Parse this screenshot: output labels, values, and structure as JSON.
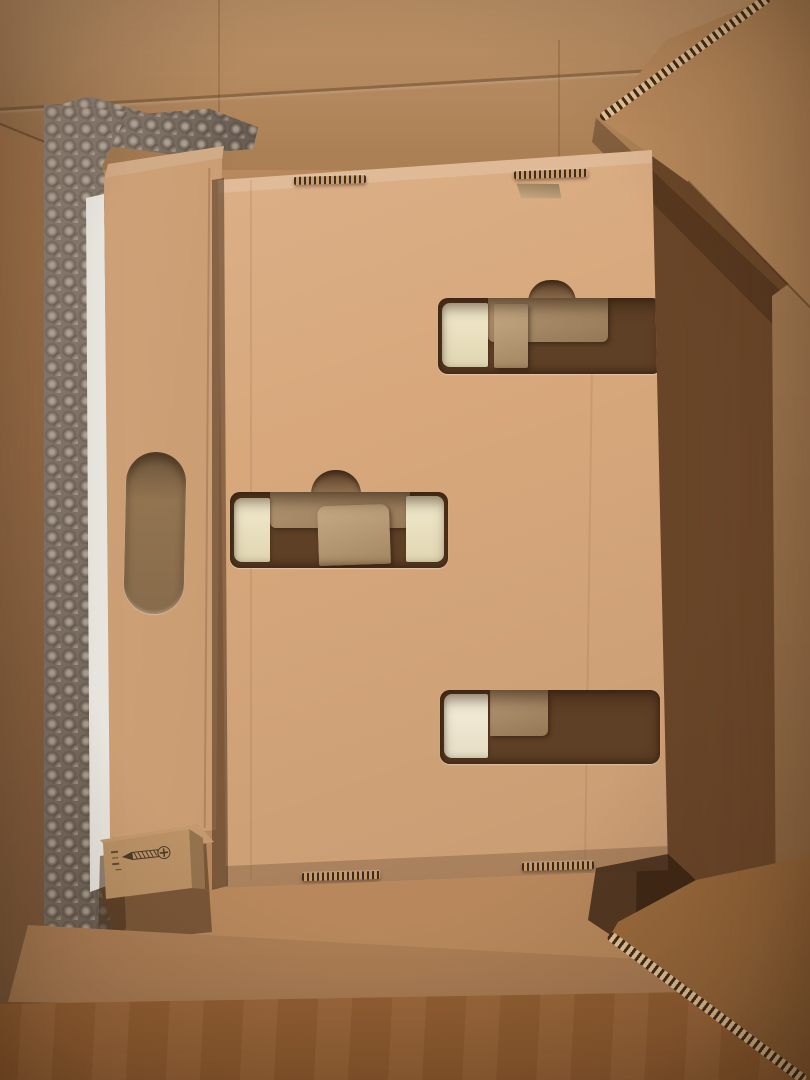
{
  "meta": {
    "type": "photograph",
    "description": "Top-down photo of an opened cardboard shipping box. Inside: a large flat cardboard insert box with three die-cut openings revealing pale wood blocks, a vertical cardboard panel with an oval hand-hole, bubble wrap and a white sheet along the left side, and a small kraft box printed with a screw pictogram. Box flaps are open at the top-right, right, bottom and bottom-right."
  },
  "palette": {
    "far_wall": "#c29160",
    "left_wall": "#a87950",
    "right_wall": "#8a5b35",
    "right_flap_strip": "#aa7c4f",
    "top_right_flap": "#bb8c5d",
    "front_wall": "#c08d5f",
    "front_flap": "#a86d3a",
    "bottom_right_flap": "#ad7743",
    "inner_box_face": "#d8a87c",
    "left_panel": "#cb9a6d",
    "cream_insert": "#eee3bd",
    "cream_insert_bright": "#f3ead0",
    "cutout_dark": "#5e4026",
    "cutout_card": "#a9885f",
    "cutout_card_light": "#bb9a6f",
    "notch_inner": "#7c5836",
    "bubble_wrap": "#857668",
    "white_sheet": "#f2efe8",
    "screw_box": "#c89a69",
    "print_ink": "#4b3a28",
    "handle_inner": "#9a7a55"
  },
  "objects": {
    "scene": {
      "label": "Top-down photo of an opened cardboard shipping box"
    },
    "far_wall": {
      "label": "Inside face of the far box wall"
    },
    "left_wall": {
      "label": "Inside face of the left box wall"
    },
    "right_wall": {
      "label": "Shadowed inside face of the right box wall"
    },
    "top_right_flap": {
      "label": "Open flap crossing the top-right corner, corrugated cut edge visible"
    },
    "right_flap": {
      "label": "Open flap along the right edge"
    },
    "front_wall": {
      "label": "Inside face of the near box wall"
    },
    "front_flap": {
      "label": "Open front flap in the foreground"
    },
    "bottom_right_flap": {
      "label": "Open flap at the bottom-right corner, corrugated edge visible"
    },
    "bubble_wrap": {
      "label": "Bubble wrap cushioning along the left side"
    },
    "white_sheet": {
      "label": "Edge of a white sheet or document"
    },
    "left_panel": {
      "label": "Vertical cardboard insert panel with oval hand-hole"
    },
    "handle": {
      "label": "Oval hand-hole cutout"
    },
    "inner_box": {
      "label": "Large flat cardboard insert box with die-cut openings and locking slots"
    },
    "cutout_top": {
      "label": "Upper-right die-cut opening with pale wood block and divider inside"
    },
    "cutout_middle": {
      "label": "Middle-left die-cut opening with pale wood blocks inside"
    },
    "cutout_bottom": {
      "label": "Lower-right die-cut opening with pale wood block inside"
    },
    "slots": {
      "label": "Die-cut locking slots showing corrugation"
    },
    "screw_box": {
      "label": "Small kraft box printed with a screw pictogram and tiny size marking"
    },
    "screw_icon": {
      "label": "screw pictogram"
    }
  }
}
